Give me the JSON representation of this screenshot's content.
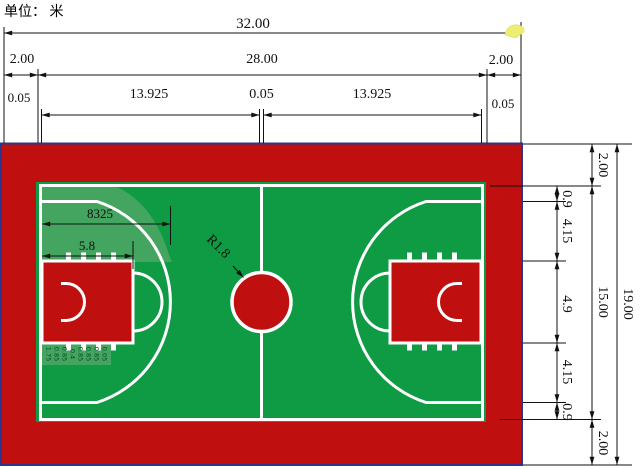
{
  "title": {
    "unit_label": "单位： 米"
  },
  "dims_top": {
    "total": "32.00",
    "left_margin": "2.00",
    "inner_width": "28.00",
    "right_margin": "2.00",
    "line_left": "0.05",
    "half_left": "13.925",
    "line_center": "0.05",
    "half_right": "13.925",
    "line_right": "0.05"
  },
  "dims_right": {
    "total_height": "19.00",
    "court_height": "15.00",
    "top_margin": "2.00",
    "side_to_arc_top": "0.9",
    "arc_to_key_top": "4.15",
    "key_width": "4.9",
    "key_to_arc_bottom": "4.15",
    "arc_to_side_bottom": "0.9",
    "bottom_margin": "2.00"
  },
  "dims_court": {
    "arc_depth": "8325",
    "key_length": "5.8",
    "center_circle_radius": "R1.8"
  },
  "lane_marks": [
    "1.75",
    "0.85",
    "0.85",
    "0.4",
    "0.85",
    "0.85",
    "0.85",
    "0.05"
  ],
  "colors": {
    "red": "#c00f0f",
    "green": "#0e9b44",
    "greenlight": "#43a55f",
    "white": "#ffffff",
    "navy": "#2b3590",
    "ink": "#111111",
    "yellow": "#eded72"
  }
}
